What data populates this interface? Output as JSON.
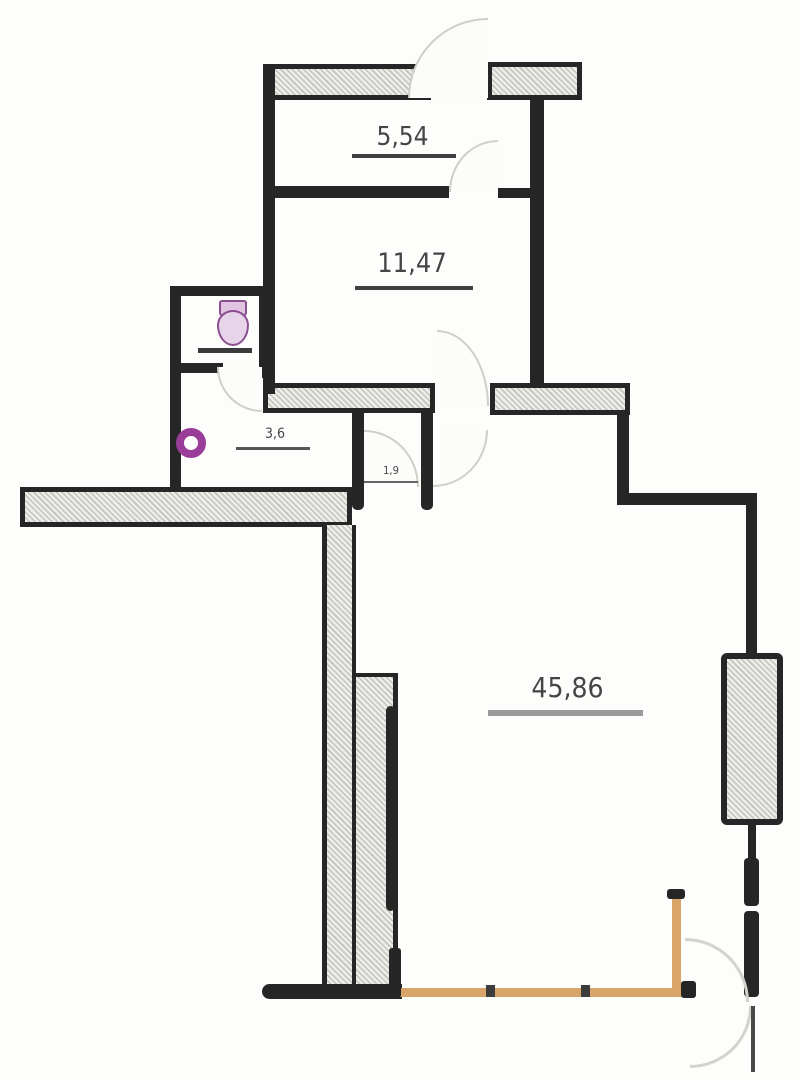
{
  "plan": {
    "title": "apartment-floor-plan",
    "rooms": [
      {
        "name": "balcony",
        "area": "5,54"
      },
      {
        "name": "bedroom",
        "area": "11,47"
      },
      {
        "name": "bathroom",
        "area": "3,6"
      },
      {
        "name": "hallway",
        "area": "1,9"
      },
      {
        "name": "living-room",
        "area": "45,86"
      }
    ],
    "fixtures": [
      {
        "name": "toilet"
      },
      {
        "name": "sink"
      },
      {
        "name": "radiator"
      },
      {
        "name": "window"
      }
    ],
    "colors": {
      "wall": "#262626",
      "hatch_light": "#ededea",
      "hatch_dark": "#c3c3be",
      "door_arc": "#cfcfc8",
      "window_frame": "#d9a468",
      "plumbing_purple": "#993d99",
      "label_text": "#454545"
    }
  }
}
